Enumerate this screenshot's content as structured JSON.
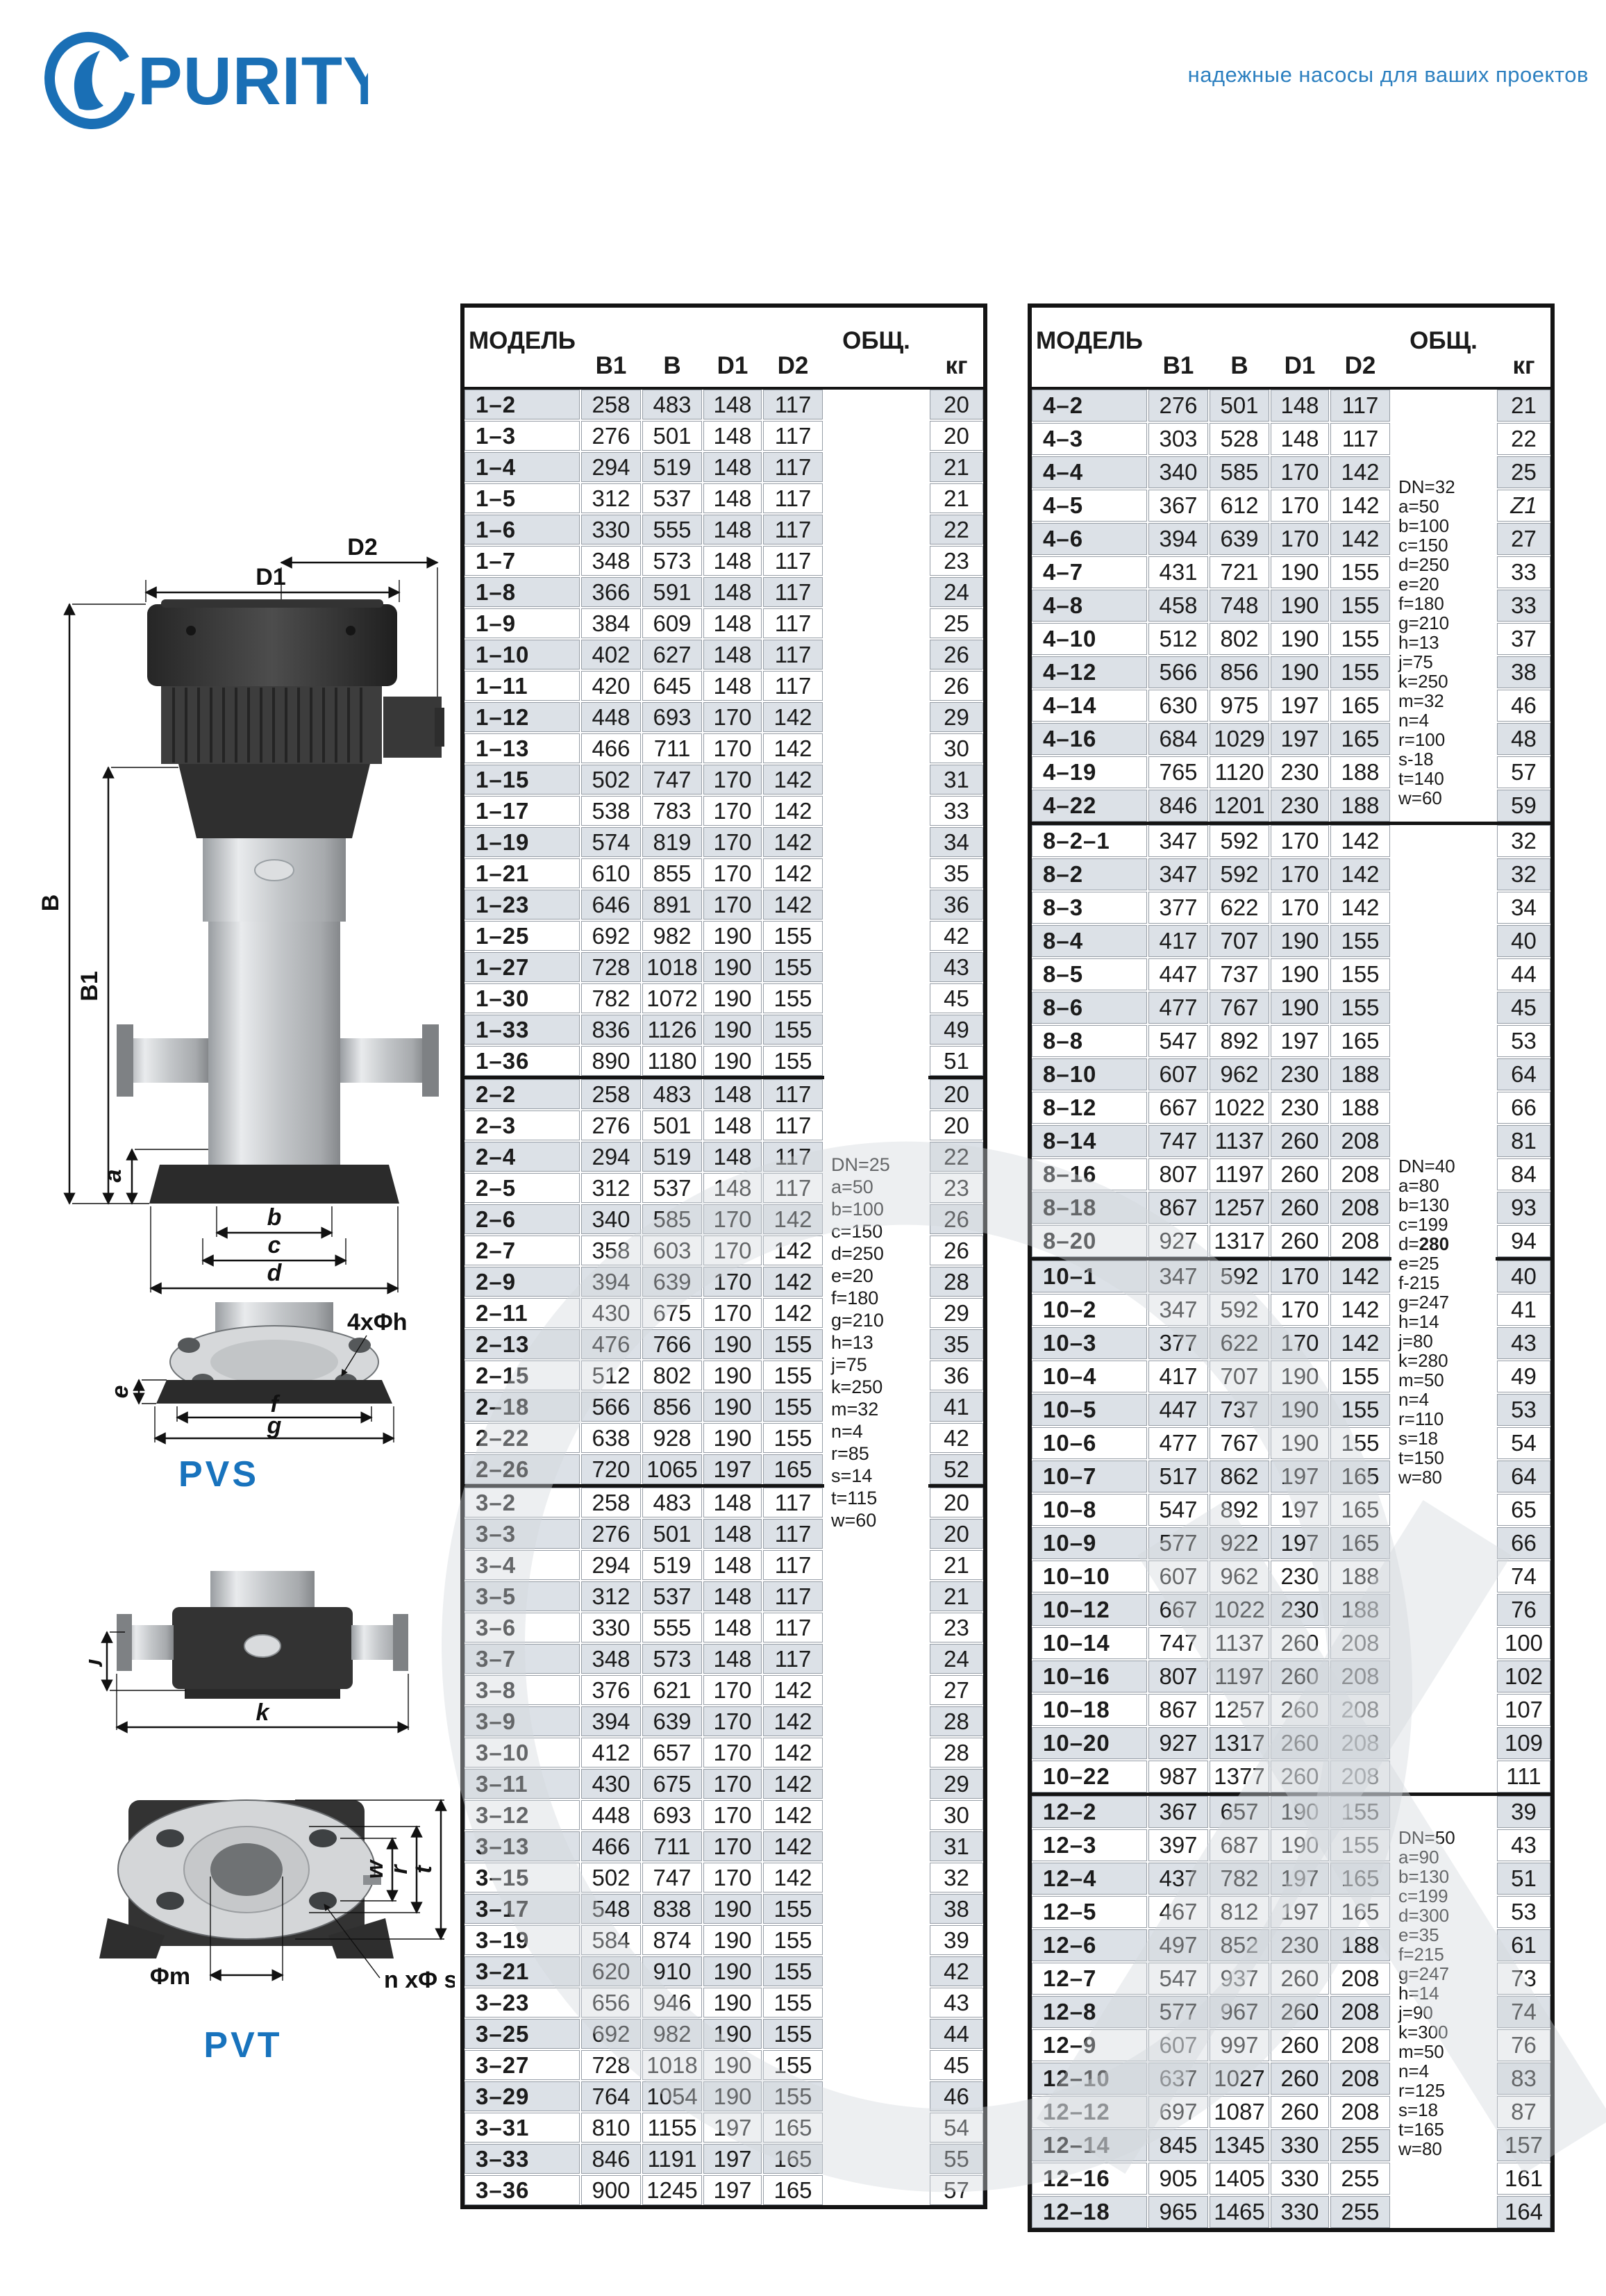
{
  "header": {
    "logo_text": "PURITY",
    "tagline": "надежные насосы для ваших проектов",
    "brand_color": "#1a6fb5",
    "tagline_color": "#2d80c0"
  },
  "diagrams": {
    "pvs_caption": "PVS",
    "pvt_caption": "PVT",
    "labels": {
      "D1": "D1",
      "D2": "D2",
      "B": "B",
      "B1": "B1",
      "a": "a",
      "b": "b",
      "c": "c",
      "d": "d",
      "e": "e",
      "f": "f",
      "g": "g",
      "bolt_holes": "4xΦh",
      "j": "j",
      "k": "k",
      "m": "Φm",
      "bolts": "n xΦ s",
      "w": "w",
      "r": "r",
      "t": "t"
    }
  },
  "tables": {
    "columns": [
      "МОДЕЛЬ",
      "B1",
      "B",
      "D1",
      "D2",
      "ОБЩ.",
      "кг"
    ],
    "row_alt_color": "#dce1e7",
    "left": {
      "groups": [
        {
          "spec": {
            "rowspan": 58,
            "lines": [
              "DN=25",
              "a=50",
              "b=100",
              "c=150",
              "d=250",
              "e=20",
              "f=180",
              "g=210",
              "h=13",
              "j=75",
              "k=250",
              "m=32",
              "n=4",
              "r=85",
              "s=14",
              "t=115",
              "w=60"
            ]
          },
          "rows": [
            [
              "1–2",
              258,
              483,
              148,
              117,
              20
            ],
            [
              "1–3",
              276,
              501,
              148,
              117,
              20
            ],
            [
              "1–4",
              294,
              519,
              148,
              117,
              21
            ],
            [
              "1–5",
              312,
              537,
              148,
              117,
              21
            ],
            [
              "1–6",
              330,
              555,
              148,
              117,
              22
            ],
            [
              "1–7",
              348,
              573,
              148,
              117,
              23
            ],
            [
              "1–8",
              366,
              591,
              148,
              117,
              24
            ],
            [
              "1–9",
              384,
              609,
              148,
              117,
              25
            ],
            [
              "1–10",
              402,
              627,
              148,
              117,
              26
            ],
            [
              "1–11",
              420,
              645,
              148,
              117,
              26
            ],
            [
              "1–12",
              448,
              693,
              170,
              142,
              29
            ],
            [
              "1–13",
              466,
              711,
              170,
              142,
              30
            ],
            [
              "1–15",
              502,
              747,
              170,
              142,
              31
            ],
            [
              "1–17",
              538,
              783,
              170,
              142,
              33
            ],
            [
              "1–19",
              574,
              819,
              170,
              142,
              34
            ],
            [
              "1–21",
              610,
              855,
              170,
              142,
              35
            ],
            [
              "1–23",
              646,
              891,
              170,
              142,
              36
            ],
            [
              "1–25",
              692,
              982,
              190,
              155,
              42
            ],
            [
              "1–27",
              728,
              1018,
              190,
              155,
              43
            ],
            [
              "1–30",
              782,
              1072,
              190,
              155,
              45
            ],
            [
              "1–33",
              836,
              1126,
              190,
              155,
              49
            ],
            [
              "1–36",
              890,
              1180,
              190,
              155,
              51
            ]
          ]
        },
        {
          "rows": [
            [
              "2–2",
              258,
              483,
              148,
              117,
              20
            ],
            [
              "2–3",
              276,
              501,
              148,
              117,
              20
            ],
            [
              "2–4",
              294,
              519,
              148,
              117,
              22
            ],
            [
              "2–5",
              312,
              537,
              148,
              117,
              23
            ],
            [
              "2–6",
              340,
              585,
              170,
              142,
              26
            ],
            [
              "2–7",
              358,
              603,
              170,
              142,
              26
            ],
            [
              "2–9",
              394,
              639,
              170,
              142,
              28
            ],
            [
              "2–11",
              430,
              675,
              170,
              142,
              29
            ],
            [
              "2–13",
              476,
              766,
              190,
              155,
              35
            ],
            [
              "2–15",
              512,
              802,
              190,
              155,
              36
            ],
            [
              "2–18",
              566,
              856,
              190,
              155,
              41
            ],
            [
              "2–22",
              638,
              928,
              190,
              155,
              42
            ],
            [
              "2–26",
              720,
              1065,
              197,
              165,
              52
            ]
          ]
        },
        {
          "rows": [
            [
              "3–2",
              258,
              483,
              148,
              117,
              20
            ],
            [
              "3–3",
              276,
              501,
              148,
              117,
              20
            ],
            [
              "3–4",
              294,
              519,
              148,
              117,
              21
            ],
            [
              "3–5",
              312,
              537,
              148,
              117,
              21
            ],
            [
              "3–6",
              330,
              555,
              148,
              117,
              23
            ],
            [
              "3–7",
              348,
              573,
              148,
              117,
              24
            ],
            [
              "3–8",
              376,
              621,
              170,
              142,
              27
            ],
            [
              "3–9",
              394,
              639,
              170,
              142,
              28
            ],
            [
              "3–10",
              412,
              657,
              170,
              142,
              28
            ],
            [
              "3–11",
              430,
              675,
              170,
              142,
              29
            ],
            [
              "3–12",
              448,
              693,
              170,
              142,
              30
            ],
            [
              "3–13",
              466,
              711,
              170,
              142,
              31
            ],
            [
              "3–15",
              502,
              747,
              170,
              142,
              32
            ],
            [
              "3–17",
              548,
              838,
              190,
              155,
              38
            ],
            [
              "3–19",
              584,
              874,
              190,
              155,
              39
            ],
            [
              "3–21",
              620,
              910,
              190,
              155,
              42
            ],
            [
              "3–23",
              656,
              946,
              190,
              155,
              43
            ],
            [
              "3–25",
              692,
              982,
              190,
              155,
              44
            ],
            [
              "3–27",
              728,
              1018,
              190,
              155,
              45
            ],
            [
              "3–29",
              764,
              1054,
              190,
              155,
              46
            ],
            [
              "3–31",
              810,
              1155,
              197,
              165,
              54
            ],
            [
              "3–33",
              846,
              1191,
              197,
              165,
              55
            ],
            [
              "3–36",
              900,
              1245,
              197,
              165,
              57
            ]
          ]
        }
      ]
    },
    "right": {
      "groups": [
        {
          "spec": {
            "rowspan": 13,
            "lines": [
              "DN=32",
              "a=50",
              "b=100",
              "c=150",
              "d=250",
              "e=20",
              "f=180",
              "g=210",
              "h=13",
              "j=75",
              "k=250",
              "m=32",
              "n=4",
              "r=100",
              "s-18",
              "t=140",
              "w=60"
            ]
          },
          "rows": [
            [
              "4–2",
              276,
              501,
              148,
              117,
              21
            ],
            [
              "4–3",
              303,
              528,
              148,
              117,
              22
            ],
            [
              "4–4",
              340,
              585,
              170,
              142,
              25
            ],
            [
              "4–5",
              367,
              612,
              170,
              142,
              "Z1"
            ],
            [
              "4–6",
              394,
              639,
              170,
              142,
              27
            ],
            [
              "4–7",
              431,
              721,
              190,
              155,
              33
            ],
            [
              "4–8",
              458,
              748,
              190,
              155,
              33
            ],
            [
              "4–10",
              512,
              802,
              190,
              155,
              37
            ],
            [
              "4–12",
              566,
              856,
              190,
              155,
              38
            ],
            [
              "4–14",
              630,
              975,
              197,
              165,
              46
            ],
            [
              "4–16",
              684,
              1029,
              197,
              165,
              48
            ],
            [
              "4–19",
              765,
              1120,
              230,
              188,
              57
            ],
            [
              "4–22",
              846,
              1201,
              230,
              188,
              59
            ]
          ]
        },
        {
          "spec": {
            "rowspan": 29,
            "bold": 4,
            "lines": [
              "DN=40",
              "a=80",
              "b=130",
              "c=199",
              "d=280",
              "e=25",
              "f-215",
              "g=247",
              "h=14",
              "j=80",
              "k=280",
              "m=50",
              "n=4",
              "r=110",
              "s=18",
              "t=150",
              "w=80"
            ]
          },
          "rows": [
            [
              "8–2–1",
              347,
              592,
              170,
              142,
              32
            ],
            [
              "8–2",
              347,
              592,
              170,
              142,
              32
            ],
            [
              "8–3",
              377,
              622,
              170,
              142,
              34
            ],
            [
              "8–4",
              417,
              707,
              190,
              155,
              40
            ],
            [
              "8–5",
              447,
              737,
              190,
              155,
              44
            ],
            [
              "8–6",
              477,
              767,
              190,
              155,
              45
            ],
            [
              "8–8",
              547,
              892,
              197,
              165,
              53
            ],
            [
              "8–10",
              607,
              962,
              230,
              188,
              64
            ],
            [
              "8–12",
              667,
              1022,
              230,
              188,
              66
            ],
            [
              "8–14",
              747,
              1137,
              260,
              208,
              81
            ],
            [
              "8–16",
              807,
              1197,
              260,
              208,
              84
            ],
            [
              "8–18",
              867,
              1257,
              260,
              208,
              93
            ],
            [
              "8–20",
              927,
              1317,
              260,
              208,
              94
            ]
          ]
        },
        {
          "rows": [
            [
              "10–1",
              347,
              592,
              170,
              142,
              40
            ],
            [
              "10–2",
              347,
              592,
              170,
              142,
              41
            ],
            [
              "10–3",
              377,
              622,
              170,
              142,
              43
            ],
            [
              "10–4",
              417,
              707,
              190,
              155,
              49
            ],
            [
              "10–5",
              447,
              737,
              190,
              155,
              53
            ],
            [
              "10–6",
              477,
              767,
              190,
              155,
              54
            ],
            [
              "10–7",
              517,
              862,
              197,
              165,
              64
            ],
            [
              "10–8",
              547,
              892,
              197,
              165,
              65
            ],
            [
              "10–9",
              577,
              922,
              197,
              165,
              66
            ],
            [
              "10–10",
              607,
              962,
              230,
              188,
              74
            ],
            [
              "10–12",
              667,
              1022,
              230,
              188,
              76
            ],
            [
              "10–14",
              747,
              1137,
              260,
              208,
              100
            ],
            [
              "10–16",
              807,
              1197,
              260,
              208,
              102
            ],
            [
              "10–18",
              867,
              1257,
              260,
              208,
              107
            ],
            [
              "10–20",
              927,
              1317,
              260,
              208,
              109
            ],
            [
              "10–22",
              987,
              1377,
              260,
              208,
              111
            ]
          ]
        },
        {
          "spec": {
            "rowspan": 13,
            "lines": [
              "DN=50",
              "a=90",
              "b=130",
              "c=199",
              "d=300",
              "e=35",
              "f=215",
              "g=247",
              "h=14",
              "j=90",
              "k=300",
              "m=50",
              "n=4",
              "r=125",
              "s=18",
              "t=165",
              "w=80"
            ]
          },
          "rows": [
            [
              "12–2",
              367,
              657,
              190,
              155,
              39
            ],
            [
              "12–3",
              397,
              687,
              190,
              155,
              43
            ],
            [
              "12–4",
              437,
              782,
              197,
              165,
              51
            ],
            [
              "12–5",
              467,
              812,
              197,
              165,
              53
            ],
            [
              "12–6",
              497,
              852,
              230,
              188,
              61
            ],
            [
              "12–7",
              547,
              937,
              260,
              208,
              73
            ],
            [
              "12–8",
              577,
              967,
              260,
              208,
              74
            ],
            [
              "12–9",
              607,
              997,
              260,
              208,
              76
            ],
            [
              "12–10",
              637,
              1027,
              260,
              208,
              83
            ],
            [
              "12–12",
              697,
              1087,
              260,
              208,
              87
            ],
            [
              "12–14",
              845,
              1345,
              330,
              255,
              157
            ],
            [
              "12–16",
              905,
              1405,
              330,
              255,
              161
            ],
            [
              "12–18",
              965,
              1465,
              330,
              255,
              164
            ]
          ]
        }
      ]
    }
  }
}
